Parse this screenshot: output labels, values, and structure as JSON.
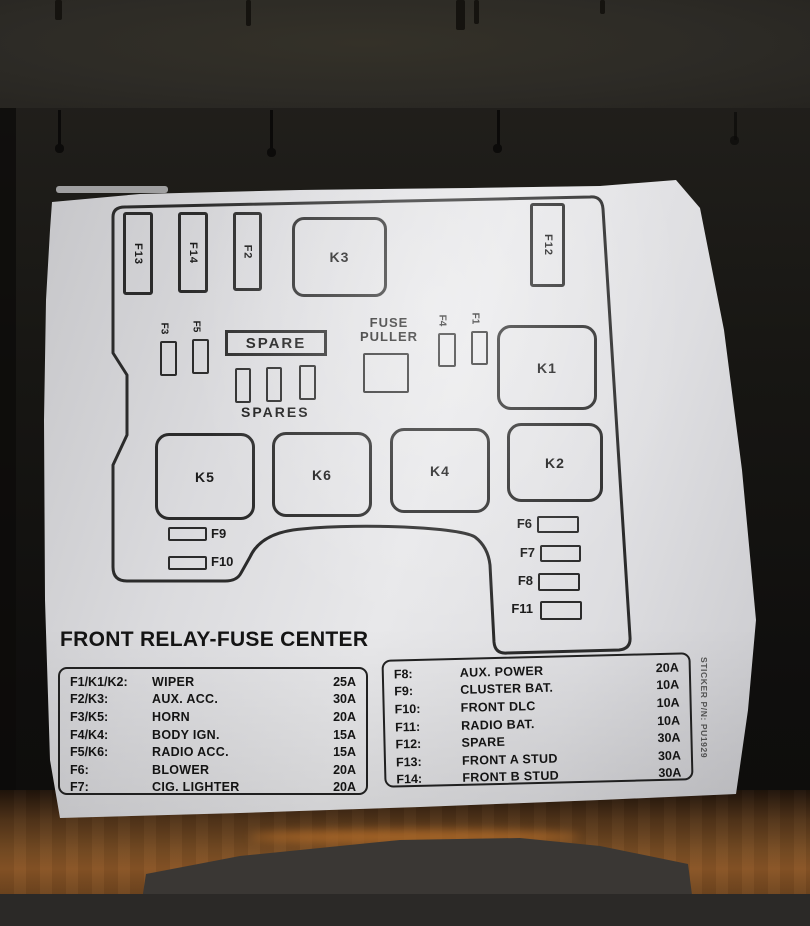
{
  "sticker": {
    "title": "FRONT RELAY-FUSE CENTER",
    "pn": "STICKER P/N: PU1929",
    "diagram": {
      "top_fuses": [
        "F13",
        "F14",
        "F2"
      ],
      "relay_k3": "K3",
      "fuse_f12": "F12",
      "small_left": [
        "F3",
        "F5"
      ],
      "spare_label": "SPARE",
      "spares_label": "SPARES",
      "fuse_puller_line1": "FUSE",
      "fuse_puller_line2": "PULLER",
      "small_right": [
        "F4",
        "F1"
      ],
      "relay_k1": "K1",
      "relays": [
        "K5",
        "K6",
        "K4",
        "K2"
      ],
      "left_fuses": [
        "F9",
        "F10"
      ],
      "right_fuses": [
        "F6",
        "F7",
        "F8",
        "F11"
      ]
    },
    "legend_left": {
      "rows": [
        {
          "code": "F1/K1/K2:",
          "name": "WIPER",
          "amp": "25A"
        },
        {
          "code": "F2/K3:",
          "name": "AUX. ACC.",
          "amp": "30A"
        },
        {
          "code": "F3/K5:",
          "name": "HORN",
          "amp": "20A"
        },
        {
          "code": "F4/K4:",
          "name": "BODY IGN.",
          "amp": "15A"
        },
        {
          "code": "F5/K6:",
          "name": "RADIO ACC.",
          "amp": "15A"
        },
        {
          "code": "F6:",
          "name": "BLOWER",
          "amp": "20A"
        },
        {
          "code": "F7:",
          "name": "CIG. LIGHTER",
          "amp": "20A"
        }
      ]
    },
    "legend_right": {
      "rows": [
        {
          "code": "F8:",
          "name": "AUX. POWER",
          "amp": "20A"
        },
        {
          "code": "F9:",
          "name": "CLUSTER BAT.",
          "amp": "10A"
        },
        {
          "code": "F10:",
          "name": "FRONT DLC",
          "amp": "10A"
        },
        {
          "code": "F11:",
          "name": "RADIO BAT.",
          "amp": "10A"
        },
        {
          "code": "F12:",
          "name": "SPARE",
          "amp": "30A"
        },
        {
          "code": "F13:",
          "name": "FRONT A STUD",
          "amp": "30A"
        },
        {
          "code": "F14:",
          "name": "FRONT B STUD",
          "amp": "30A"
        }
      ]
    }
  }
}
